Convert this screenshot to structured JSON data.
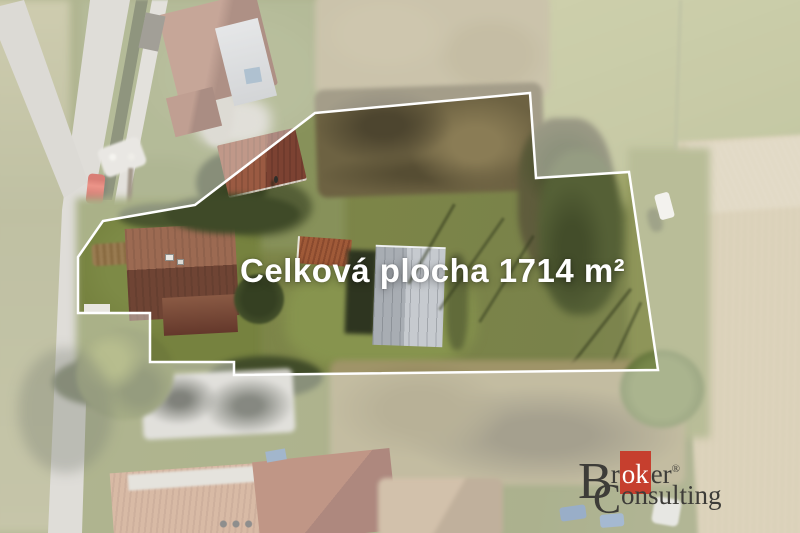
{
  "watermark": {
    "area_label": "Celková plocha 1714 m²",
    "text_color": "#ffffff"
  },
  "boundary": {
    "points_str": "315,113 530,93 536,178 629,172 658,370 234,375 234,362 150,362 150,313 78,313 78,257 103,221 195,205",
    "veil_path": "M0 0 H800 V533 H0 Z M315 113 L530 93 L536 178 L629 172 L658 370 L234 375 L234 362 L150 362 L150 313 L78 313 L78 257 L103 221 L195 205 Z",
    "stroke_color": "#ffffff",
    "veil_opacity": "0.38"
  },
  "logo": {
    "brand_line1": {
      "initial": "B",
      "pre": "r",
      "highlight": "ok",
      "post": "er",
      "registered": "®"
    },
    "brand_line2": {
      "initial": "C",
      "rest": "onsulting"
    },
    "highlight_bg": "#c63f2e",
    "text_color": "#3d3c38"
  },
  "palette": {
    "meadow_green": "#7c8548",
    "shadow_green": "#46502c",
    "brush_brown": "#6d6242",
    "field_tan": "#cbbc97",
    "road_gray": "#cbc8c0",
    "roof_red": "#8a5340",
    "barn_gray": "#bfc4c9",
    "car_red": "#d93a28"
  }
}
